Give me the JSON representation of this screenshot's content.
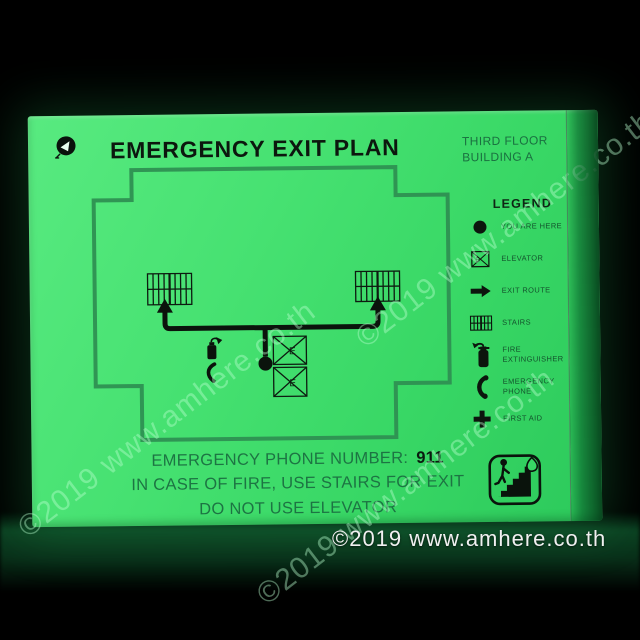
{
  "sign": {
    "title": "EMERGENCY EXIT PLAN",
    "location": "THIRD FLOOR\nBUILDING A",
    "legend": {
      "title": "LEGEND",
      "items": [
        {
          "icon": "you-are-here-dot-icon",
          "label": "YOU ARE HERE"
        },
        {
          "icon": "elevator-icon",
          "label": "ELEVATOR"
        },
        {
          "icon": "exit-route-arrow-icon",
          "label": "EXIT ROUTE"
        },
        {
          "icon": "stairs-icon",
          "label": "STAIRS"
        },
        {
          "icon": "fire-extinguisher-icon",
          "label": "FIRE EXTINGUISHER"
        },
        {
          "icon": "emergency-phone-icon",
          "label": "EMERGENCY PHONE"
        },
        {
          "icon": "first-aid-cross-icon",
          "label": "FIRST AID"
        }
      ]
    },
    "floor_plan": {
      "elevator_label": "E"
    },
    "instructions": {
      "phone_label": "EMERGENCY PHONE NUMBER:",
      "phone_number": "911",
      "line2": "IN CASE OF FIRE, USE STAIRS FOR EXIT",
      "line3": "DO NOT USE ELEVATOR"
    },
    "colors": {
      "glow_green": "#46e171",
      "outline_green": "#2e9052",
      "ink": "#0c150d"
    }
  },
  "watermark": {
    "diagonal": "©2019 www.amhere.co.th",
    "bottom": "©2019 www.amhere.co.th"
  }
}
